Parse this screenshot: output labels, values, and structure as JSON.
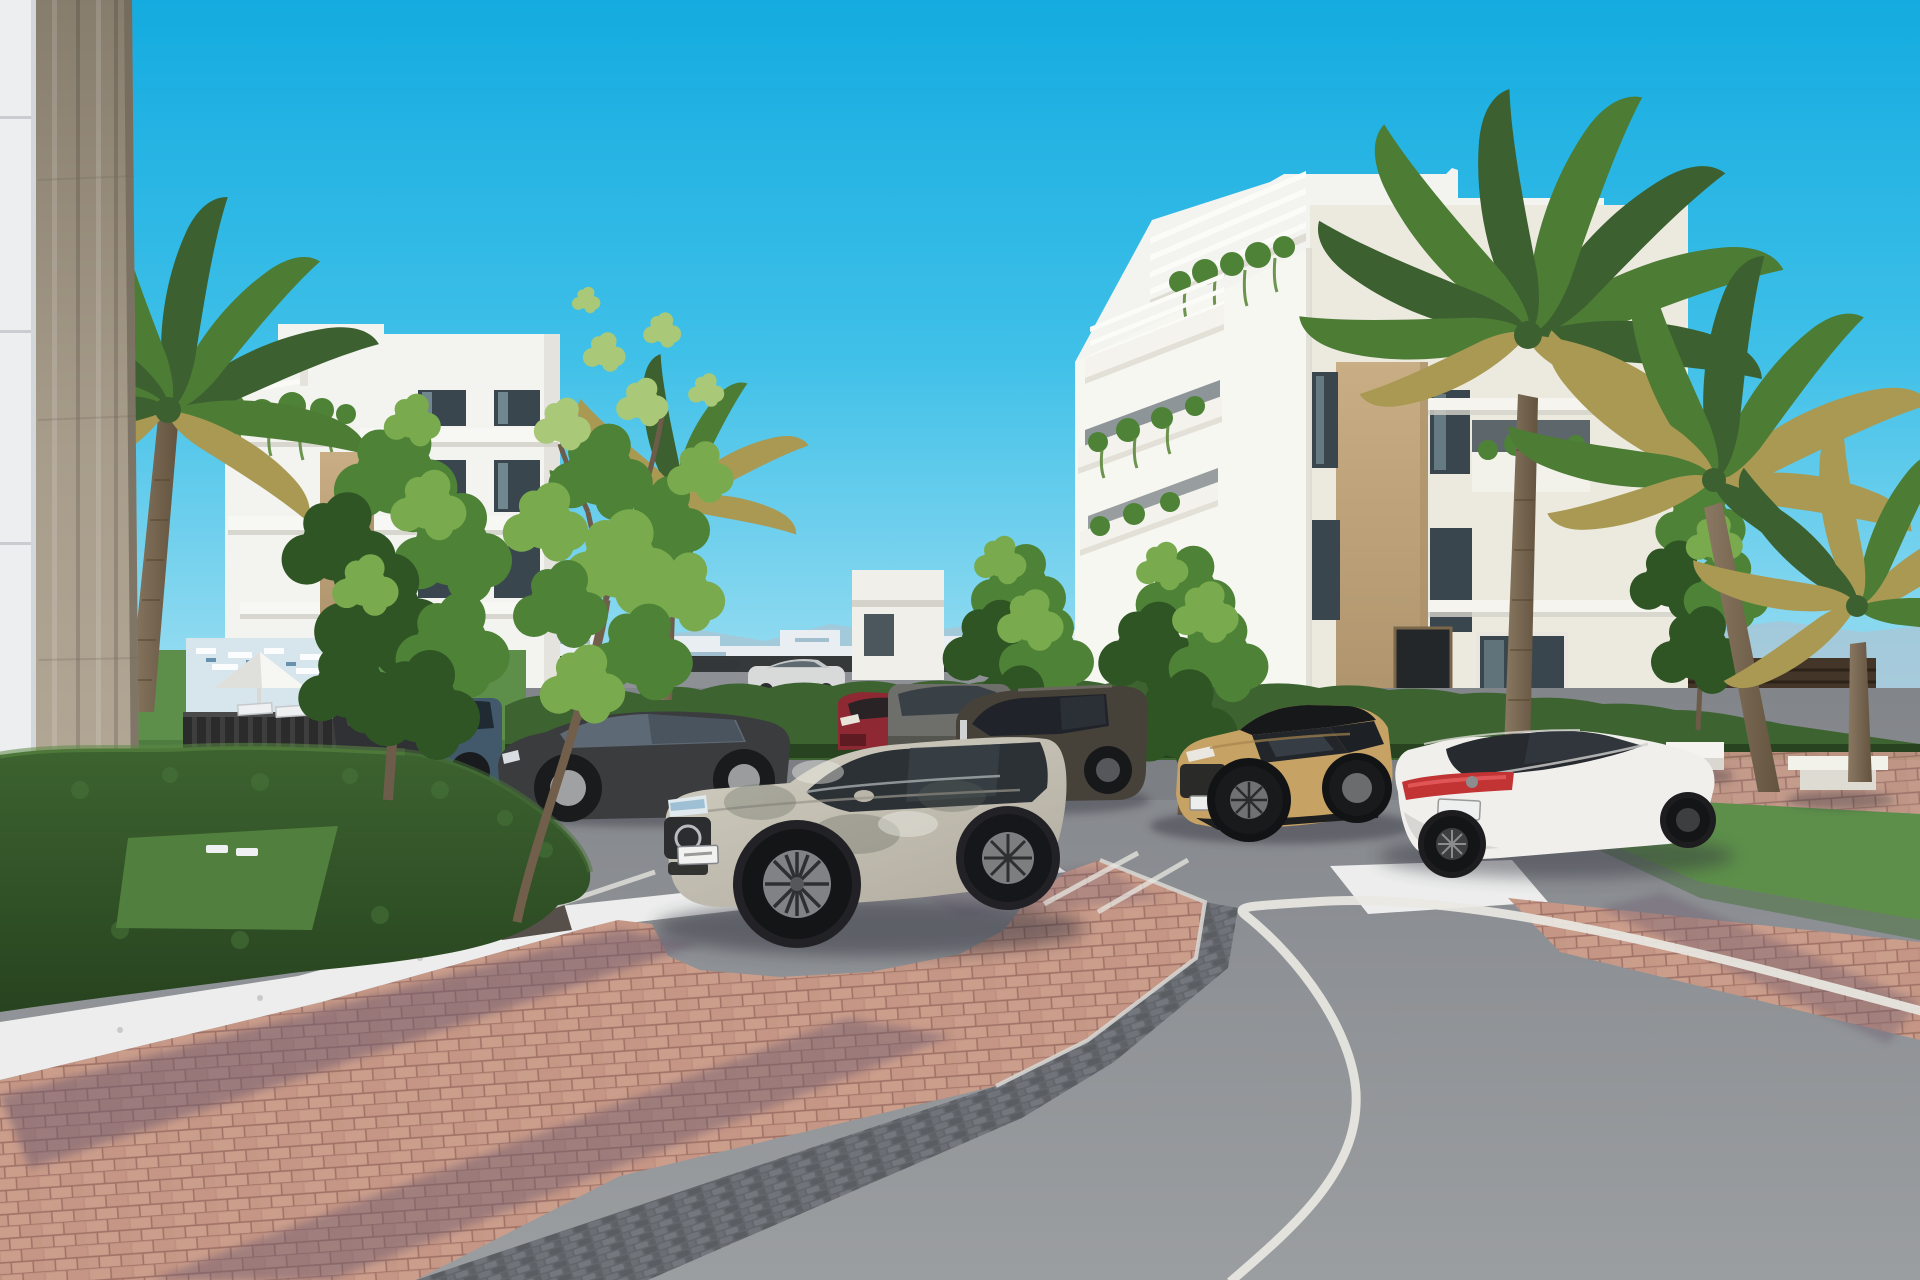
{
  "scene": {
    "type": "3d-architectural-rendering",
    "setting": "modern white apartment complex with landscaped parking lot, palm trees and curving asphalt road",
    "sky": "clear bright cyan",
    "objects": [
      "apartment-building-left",
      "apartment-building-right",
      "concrete-column-foreground",
      "white-panel-wall",
      "palm-trees",
      "deciduous-trees",
      "boxwood-hedges",
      "lawn",
      "parasol",
      "sun-loungers",
      "benches",
      "parking-lot",
      "parking-stall-lines",
      "brick-walkway",
      "gravel-strip",
      "traffic-island",
      "curved-road",
      "road-edge-line",
      "silver-mercedes-suv",
      "dark-gray-suv",
      "tan-compact-suv",
      "white-mercedes-sedan",
      "dark-sedan",
      "blue-suv",
      "red-suv",
      "distant-driving-car",
      "distant-city-skyline",
      "mountain-ridge",
      "boundary-fence"
    ],
    "vehicle_count": 10
  },
  "palette": {
    "sky_top": "#14abe0",
    "sky_mid": "#3fc0e8",
    "sky_low": "#8fdaf0",
    "sky_horizon": "#c9edf6",
    "mountain": "#a9c6d6",
    "city_white": "#e8eef2",
    "city_shade": "#c3d2da",
    "city_blue": "#8fb3c4",
    "fence_dark": "#26292a",
    "fence_brown": "#433528",
    "hedge_top": "#4f7d3c",
    "hedge_mid": "#3d6330",
    "hedge_dark": "#27431f",
    "lawn": "#5d8f4a",
    "lawn_dark": "#46703a",
    "tree_dark": "#2f5524",
    "tree_mid": "#4e8236",
    "tree_light": "#79ab4e",
    "tree_pale": "#a9c878",
    "palm_green": "#4d7c35",
    "palm_deep": "#3c6030",
    "palm_gold": "#a99953",
    "trunk_light": "#8a7862",
    "trunk_dark": "#63543f",
    "bldg_white": "#f3f3ef",
    "bldg_bright": "#f7f7f2",
    "bldg_shade": "#dddcd6",
    "bldg_warm": "#eceadf",
    "stone_tan": "#c9ad84",
    "stone_tan_dark": "#a98f68",
    "window_dark": "#39464e",
    "glass_light": "#a8c8d2",
    "column_top": "#877d6d",
    "column_mid": "#a89d8b",
    "column_low": "#b6aa99",
    "wall_white": "#eceef0",
    "asphalt_far": "#82858a",
    "asphalt_near": "#9b9ea1",
    "road_line": "#e9e8e2",
    "brick": "#c09080",
    "brick_light": "#d2a794",
    "brick_shadow": "#6d5a6d",
    "cobble": "#63666b",
    "gravel": "#ecedec",
    "car_silver": "#c9c5b9",
    "car_dark": "#474239",
    "car_sedan": "#3b3c3e",
    "car_blue": "#41596b",
    "car_red": "#8e2833",
    "car_tan": "#c7a265",
    "car_white": "#f0efec",
    "tail_red": "#c23333",
    "shadow": "#30303c"
  }
}
